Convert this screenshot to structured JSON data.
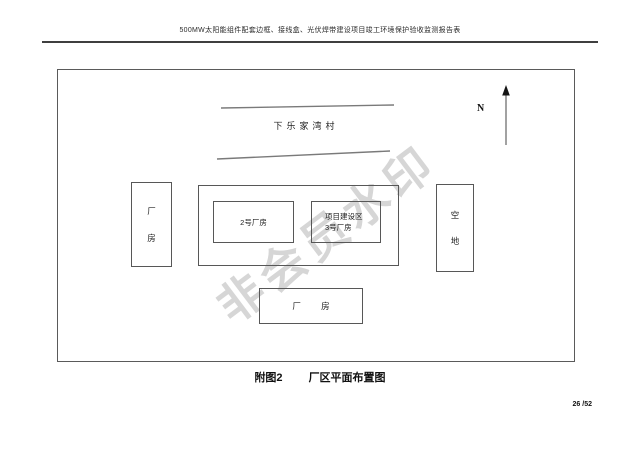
{
  "header": {
    "title": "500MW太阳能组件配套边框、接线盒、光伏焊带建设项目竣工环境保护验收监测报告表"
  },
  "watermark": {
    "text": "非会员水印"
  },
  "diagram": {
    "village_label": "下乐家湾村",
    "north_label": "N",
    "left_building": {
      "chars": [
        "厂",
        "房"
      ]
    },
    "vacant_lot": {
      "chars": [
        "空",
        "地"
      ]
    },
    "workshop2_label": "2号厂房",
    "project_area_lines": [
      "项目建设区",
      "3号厂房"
    ],
    "bottom_building_label": "厂 房"
  },
  "caption": {
    "figure_label": "附图2",
    "title": "厂区平面布置图"
  },
  "footer": {
    "page_number": "26 /52"
  },
  "colors": {
    "line": "#5a5a5a",
    "road_line": "#7a7a7a",
    "watermark": "#d6d6d6"
  }
}
